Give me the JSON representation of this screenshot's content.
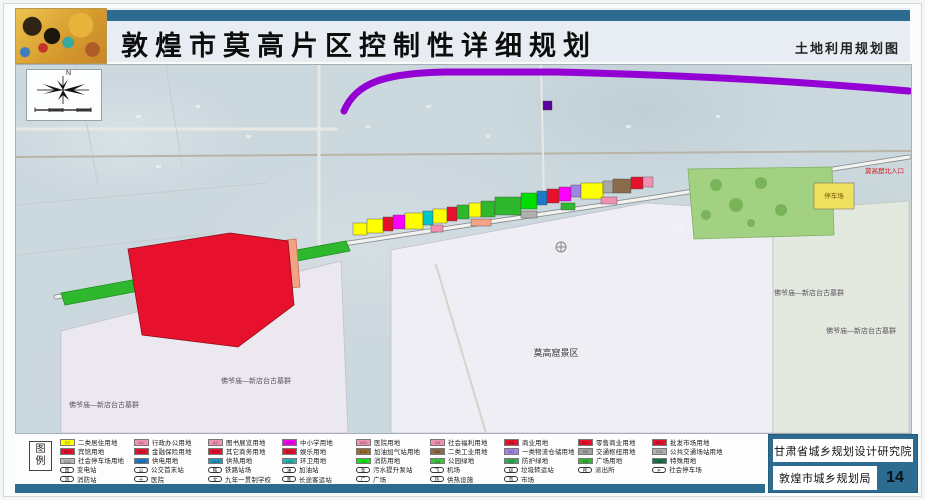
{
  "header": {
    "title": "敦煌市莫高片区控制性详细规划",
    "subtitle": "土地利用规划图"
  },
  "compass": {
    "north": "N"
  },
  "map": {
    "zones": [
      {
        "points": "45,266 325,196 332,368 45,368",
        "fill": "#ebe8f0",
        "stroke": "#c4bfd2"
      },
      {
        "points": "375,185 630,138 757,146 757,368 375,368",
        "fill": "#efeef5",
        "stroke": "#c4bfd2"
      },
      {
        "points": "757,146 893,136 893,368 757,368",
        "fill": "#e4e9e0",
        "stroke": "#bec4ba"
      }
    ],
    "roads": [
      {
        "d": "M0,64 L320,64",
        "stroke": "#e8e8e4",
        "width": 3
      },
      {
        "d": "M0,140 L250,118",
        "stroke": "#c2ccd2",
        "width": 1
      },
      {
        "d": "M0,190 L200,168",
        "stroke": "#c2ccd2",
        "width": 1
      },
      {
        "d": "M60,0 L82,120",
        "stroke": "#c2ccd2",
        "width": 1
      },
      {
        "d": "M150,0 L166,100",
        "stroke": "#c2ccd2",
        "width": 1
      },
      {
        "d": "M0,92 L895,86",
        "stroke": "#b9b4a8",
        "width": 2
      },
      {
        "d": "M303,0 L303,182",
        "stroke": "#e8e8e4",
        "width": 3
      },
      {
        "d": "M525,0 L528,132",
        "stroke": "#e8e8e4",
        "width": 2
      },
      {
        "d": "M420,200 L470,368",
        "stroke": "#d4d4cc",
        "width": 2
      },
      {
        "d": "M40,232 L320,180 L640,132 L893,92",
        "stroke": "#8a8f93",
        "width": 5
      },
      {
        "d": "M40,232 L320,180 L640,132 L893,92",
        "stroke": "#f2f2ee",
        "width": 3.2
      }
    ],
    "areas": [
      {
        "points": "672,104 816,102 818,170 678,174",
        "fill": "#a2d182",
        "stroke": "#7fb063"
      },
      {
        "points": "45,228 330,176 334,186 49,240",
        "fill": "#2eb82e",
        "stroke": "#1f8f1f"
      },
      {
        "points": "216,182 280,174 284,222 220,228",
        "fill": "#f2a285",
        "stroke": "#d07050"
      },
      {
        "points": "112,184 214,168 272,176 278,240 222,282 126,270",
        "fill": "#e8112d",
        "stroke": "#8f0f18"
      }
    ],
    "parcels": [
      {
        "x": 337,
        "y": 158,
        "w": 14,
        "h": 12,
        "fill": "#ffff00"
      },
      {
        "x": 351,
        "y": 154,
        "w": 16,
        "h": 14,
        "fill": "#ffff00"
      },
      {
        "x": 367,
        "y": 152,
        "w": 10,
        "h": 14,
        "fill": "#e8112d"
      },
      {
        "x": 377,
        "y": 150,
        "w": 12,
        "h": 14,
        "fill": "#ff00ff"
      },
      {
        "x": 389,
        "y": 148,
        "w": 18,
        "h": 16,
        "fill": "#ffff00"
      },
      {
        "x": 407,
        "y": 146,
        "w": 10,
        "h": 14,
        "fill": "#00c8c8"
      },
      {
        "x": 417,
        "y": 144,
        "w": 14,
        "h": 14,
        "fill": "#ffff00"
      },
      {
        "x": 431,
        "y": 142,
        "w": 10,
        "h": 14,
        "fill": "#e8112d"
      },
      {
        "x": 441,
        "y": 140,
        "w": 12,
        "h": 14,
        "fill": "#2eb82e"
      },
      {
        "x": 453,
        "y": 138,
        "w": 12,
        "h": 14,
        "fill": "#ffff00"
      },
      {
        "x": 465,
        "y": 136,
        "w": 14,
        "h": 16,
        "fill": "#2eb82e"
      },
      {
        "x": 479,
        "y": 132,
        "w": 26,
        "h": 18,
        "fill": "#2eb82e"
      },
      {
        "x": 505,
        "y": 128,
        "w": 16,
        "h": 16,
        "fill": "#00dd00"
      },
      {
        "x": 521,
        "y": 126,
        "w": 10,
        "h": 14,
        "fill": "#1f78c8"
      },
      {
        "x": 531,
        "y": 124,
        "w": 12,
        "h": 14,
        "fill": "#e8112d"
      },
      {
        "x": 543,
        "y": 122,
        "w": 12,
        "h": 14,
        "fill": "#ff00ff"
      },
      {
        "x": 555,
        "y": 120,
        "w": 10,
        "h": 12,
        "fill": "#9f86e0"
      },
      {
        "x": 565,
        "y": 118,
        "w": 22,
        "h": 16,
        "fill": "#ffff00"
      },
      {
        "x": 587,
        "y": 116,
        "w": 10,
        "h": 12,
        "fill": "#a8a8a8"
      },
      {
        "x": 597,
        "y": 114,
        "w": 18,
        "h": 14,
        "fill": "#8a6b4a"
      },
      {
        "x": 615,
        "y": 112,
        "w": 12,
        "h": 12,
        "fill": "#e8112d"
      },
      {
        "x": 627,
        "y": 112,
        "w": 10,
        "h": 10,
        "fill": "#f191b2"
      },
      {
        "x": 415,
        "y": 160,
        "w": 12,
        "h": 7,
        "fill": "#f191b2"
      },
      {
        "x": 455,
        "y": 154,
        "w": 20,
        "h": 7,
        "fill": "#f2a285"
      },
      {
        "x": 505,
        "y": 146,
        "w": 16,
        "h": 7,
        "fill": "#b0b0b0"
      },
      {
        "x": 545,
        "y": 138,
        "w": 14,
        "h": 7,
        "fill": "#2eb82e"
      },
      {
        "x": 585,
        "y": 132,
        "w": 16,
        "h": 7,
        "fill": "#f191b2"
      },
      {
        "x": 527,
        "y": 36,
        "w": 9,
        "h": 9,
        "fill": "#5a00a0"
      },
      {
        "x": 798,
        "y": 118,
        "w": 40,
        "h": 26,
        "fill": "#f0e060"
      }
    ],
    "highway": {
      "d": "M328,46 C340,18 368,8 430,7 L540,7 C700,11 800,18 893,26",
      "color": "#9400d3",
      "width": 7
    },
    "labels": [
      {
        "text": "莫高窟景区",
        "x": 540,
        "y": 291,
        "size": 9,
        "color": "#3a3a3a"
      },
      {
        "text": "佛爷庙—新店台古墓群",
        "x": 240,
        "y": 318,
        "size": 7,
        "color": "#5a5560"
      },
      {
        "text": "佛爷庙—新店台古墓群",
        "x": 88,
        "y": 342,
        "size": 7,
        "color": "#5a5560"
      },
      {
        "text": "佛爷庙—新店台古墓群",
        "x": 793,
        "y": 230,
        "size": 7,
        "color": "#5a5560"
      },
      {
        "text": "佛爷庙—新店台古墓群",
        "x": 845,
        "y": 268,
        "size": 7,
        "color": "#5a5560"
      },
      {
        "text": "莫高窟北入口",
        "x": 888,
        "y": 108,
        "size": 6.5,
        "color": "#cc2020",
        "anchor": "end"
      },
      {
        "text": "停车场",
        "x": 818,
        "y": 133,
        "size": 6.5,
        "color": "#7a5500"
      }
    ]
  },
  "legend": {
    "title": "图例",
    "columns": [
      {
        "items": [
          {
            "type": "swatch",
            "color": "#ffff00",
            "code": "R2",
            "label": "二类居住用地"
          },
          {
            "type": "swatch",
            "color": "#e8112d",
            "code": "B14",
            "label": "宾馆用地"
          },
          {
            "type": "swatch",
            "color": "#b9b9b9",
            "code": "S42",
            "label": "社会停车场用地"
          },
          {
            "type": "icon",
            "icon": "substation",
            "glyph": "电",
            "label": "变电站"
          },
          {
            "type": "icon",
            "icon": "fire-station",
            "glyph": "消",
            "label": "消防站"
          }
        ]
      },
      {
        "items": [
          {
            "type": "swatch",
            "color": "#f191b2",
            "code": "A1",
            "label": "行政办公用地"
          },
          {
            "type": "swatch",
            "color": "#e8112d",
            "code": "B21",
            "label": "金融保险用地"
          },
          {
            "type": "swatch",
            "color": "#1f78c8",
            "code": "U12",
            "label": "供电用地"
          },
          {
            "type": "icon",
            "icon": "bus-terminal",
            "glyph": "公",
            "label": "公交首末站"
          },
          {
            "type": "icon",
            "icon": "hospital",
            "glyph": "十",
            "label": "医院"
          }
        ]
      },
      {
        "items": [
          {
            "type": "swatch",
            "color": "#f191b2",
            "code": "A2",
            "label": "图书展览用地"
          },
          {
            "type": "swatch",
            "color": "#e8112d",
            "code": "B29",
            "label": "其它商务用地"
          },
          {
            "type": "swatch",
            "color": "#1f9bbe",
            "code": "U15",
            "label": "供热用地"
          },
          {
            "type": "icon",
            "icon": "railway-station",
            "glyph": "铁",
            "label": "铁路站场"
          },
          {
            "type": "icon",
            "icon": "school",
            "glyph": "文",
            "label": "九年一贯制学校"
          }
        ]
      },
      {
        "items": [
          {
            "type": "swatch",
            "color": "#f400f4",
            "code": "A33",
            "label": "中小学用地"
          },
          {
            "type": "swatch",
            "color": "#e8112d",
            "code": "B31",
            "label": "娱乐用地"
          },
          {
            "type": "swatch",
            "color": "#28b4b4",
            "code": "U22",
            "label": "环卫用地"
          },
          {
            "type": "icon",
            "icon": "gas-station",
            "glyph": "油",
            "label": "加油站"
          },
          {
            "type": "icon",
            "icon": "coach-station",
            "glyph": "客",
            "label": "长途客运站"
          }
        ]
      },
      {
        "items": [
          {
            "type": "swatch",
            "color": "#f191b2",
            "code": "A51",
            "label": "医院用地"
          },
          {
            "type": "swatch",
            "color": "#9c6b30",
            "code": "B41",
            "label": "加油加气站用地"
          },
          {
            "type": "swatch",
            "color": "#19e119",
            "code": "U3",
            "label": "消防用地"
          },
          {
            "type": "icon",
            "icon": "pump-station",
            "glyph": "泵",
            "label": "污水提升泵站"
          },
          {
            "type": "icon",
            "icon": "plaza",
            "glyph": "广",
            "label": "广场"
          }
        ]
      },
      {
        "items": [
          {
            "type": "swatch",
            "color": "#f191b2",
            "code": "A6",
            "label": "社会福利用地"
          },
          {
            "type": "swatch",
            "color": "#8a6b4a",
            "code": "M2",
            "label": "二类工业用地"
          },
          {
            "type": "swatch",
            "color": "#3fc33f",
            "code": "G1",
            "label": "公园绿地"
          },
          {
            "type": "icon",
            "icon": "airport",
            "glyph": "飞",
            "label": "机场"
          },
          {
            "type": "icon",
            "icon": "heating-facility",
            "glyph": "热",
            "label": "供热设施"
          }
        ]
      },
      {
        "items": [
          {
            "type": "swatch",
            "color": "#e8112d",
            "code": "B1",
            "label": "商业用地"
          },
          {
            "type": "swatch",
            "color": "#9f86e0",
            "code": "W1",
            "label": "一类物流仓储用地"
          },
          {
            "type": "swatch",
            "color": "#2fae4f",
            "code": "G2",
            "label": "防护绿地"
          },
          {
            "type": "icon",
            "icon": "garbage-transfer",
            "glyph": "圾",
            "label": "垃圾转运站"
          },
          {
            "type": "icon",
            "icon": "market",
            "glyph": "市",
            "label": "市场"
          }
        ]
      },
      {
        "items": [
          {
            "type": "swatch",
            "color": "#e8112d",
            "code": "B11",
            "label": "零售商业用地"
          },
          {
            "type": "swatch",
            "color": "#a0a0a0",
            "code": "S3",
            "label": "交通枢纽用地"
          },
          {
            "type": "swatch",
            "color": "#35b335",
            "code": "G3",
            "label": "广场用地"
          },
          {
            "type": "icon",
            "icon": "police-station",
            "glyph": "所",
            "label": "派出所"
          }
        ]
      },
      {
        "items": [
          {
            "type": "swatch",
            "color": "#e8112d",
            "code": "B12",
            "label": "批发市场用地"
          },
          {
            "type": "swatch",
            "color": "#b0b0b0",
            "code": "S41",
            "label": "公共交通场站用地"
          },
          {
            "type": "swatch",
            "color": "#1e6e46",
            "code": "H4",
            "label": "特殊用地"
          },
          {
            "type": "icon",
            "icon": "parking",
            "glyph": "P",
            "label": "社会停车场"
          }
        ]
      }
    ]
  },
  "footer": {
    "institute": "甘肃省城乡规划设计研究院",
    "bureau": "敦煌市城乡规划局",
    "page": "14"
  }
}
